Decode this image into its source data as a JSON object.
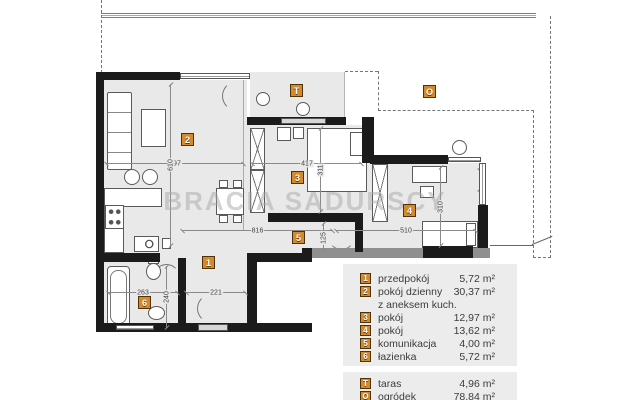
{
  "watermark": "BRACIA SADURSCY",
  "colors": {
    "wall": "#1b1b1b",
    "secondary_wall": "#8f8f8f",
    "floor": "#e9e9e9",
    "marker_orange": "#d48a2c",
    "legend_bg": "#ececec"
  },
  "markers": [
    {
      "id": "1",
      "x": 202,
      "y": 256
    },
    {
      "id": "2",
      "x": 181,
      "y": 133
    },
    {
      "id": "3",
      "x": 291,
      "y": 171
    },
    {
      "id": "4",
      "x": 403,
      "y": 204
    },
    {
      "id": "5",
      "x": 292,
      "y": 231
    },
    {
      "id": "6",
      "x": 138,
      "y": 296
    },
    {
      "id": "T",
      "x": 290,
      "y": 84
    },
    {
      "id": "O",
      "x": 423,
      "y": 85
    }
  ],
  "dimensions": [
    {
      "text": "497",
      "orient": "h",
      "x": 106,
      "y": 163,
      "len": 138
    },
    {
      "text": "610",
      "orient": "v",
      "x": 170,
      "y": 84,
      "len": 162
    },
    {
      "text": "417",
      "orient": "h",
      "x": 252,
      "y": 163,
      "len": 110
    },
    {
      "text": "311",
      "orient": "v",
      "x": 320,
      "y": 128,
      "len": 84
    },
    {
      "text": "816",
      "orient": "h",
      "x": 182,
      "y": 230,
      "len": 151
    },
    {
      "text": "125",
      "orient": "v",
      "x": 323,
      "y": 223,
      "len": 29
    },
    {
      "text": "510",
      "orient": "h",
      "x": 336,
      "y": 230,
      "len": 140
    },
    {
      "text": "310",
      "orient": "v",
      "x": 440,
      "y": 167,
      "len": 79
    },
    {
      "text": "263",
      "orient": "h",
      "x": 108,
      "y": 292,
      "len": 70
    },
    {
      "text": "221",
      "orient": "h",
      "x": 186,
      "y": 292,
      "len": 60
    },
    {
      "text": "240",
      "orient": "v",
      "x": 166,
      "y": 266,
      "len": 62
    }
  ],
  "legend": {
    "rooms": [
      {
        "num": "1",
        "label": "przedpokój",
        "area": "5,72 m²"
      },
      {
        "num": "2",
        "label": "pokój dzienny",
        "area": "30,37 m²",
        "cont": "z aneksem kuch."
      },
      {
        "num": "3",
        "label": "pokój",
        "area": "12,97 m²"
      },
      {
        "num": "4",
        "label": "pokój",
        "area": "13,62 m²"
      },
      {
        "num": "5",
        "label": "komunikacja",
        "area": "4,00 m²"
      },
      {
        "num": "6",
        "label": "łazienka",
        "area": "5,72 m²"
      }
    ],
    "outdoor": [
      {
        "num": "T",
        "label": "taras",
        "area": "4,96 m²"
      },
      {
        "num": "O",
        "label": "ogródek",
        "area": "78,84 m²"
      }
    ]
  }
}
